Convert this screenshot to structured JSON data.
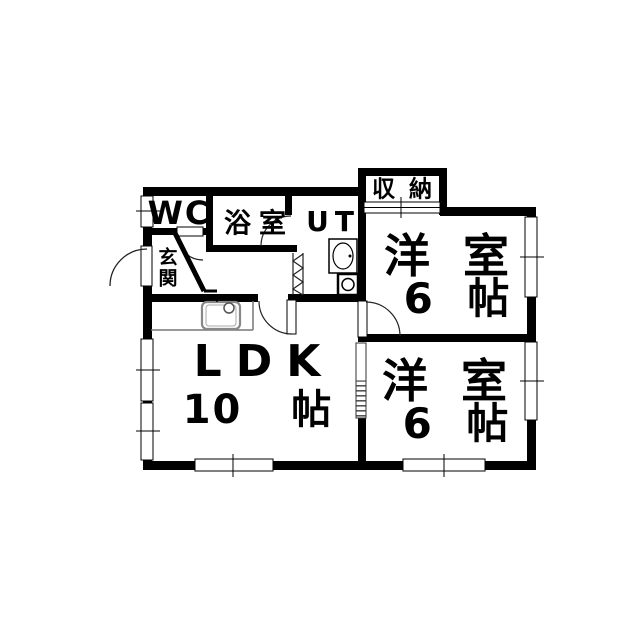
{
  "floorplan": {
    "rooms": {
      "wc": {
        "label": "WC"
      },
      "bathroom": {
        "label": "浴室"
      },
      "utility": {
        "label": "UT"
      },
      "closet": {
        "label": "収納"
      },
      "entrance": {
        "label": "玄関"
      },
      "bedroom_upper": {
        "name": "洋 室",
        "size": "6 帖"
      },
      "bedroom_lower": {
        "name": "洋 室",
        "size": "6 帖"
      },
      "ldk": {
        "name": "LDK",
        "size": "10 帖"
      }
    },
    "fixtures": [
      "kitchen-sink",
      "faucet",
      "washbasin",
      "washing-machine-pan",
      "entrance-step",
      "folding-door",
      "sliding-door",
      "hinged-doors",
      "windows"
    ],
    "colors": {
      "wall": "#000000",
      "background": "#ffffff",
      "fixture_gray": "#888888"
    }
  }
}
